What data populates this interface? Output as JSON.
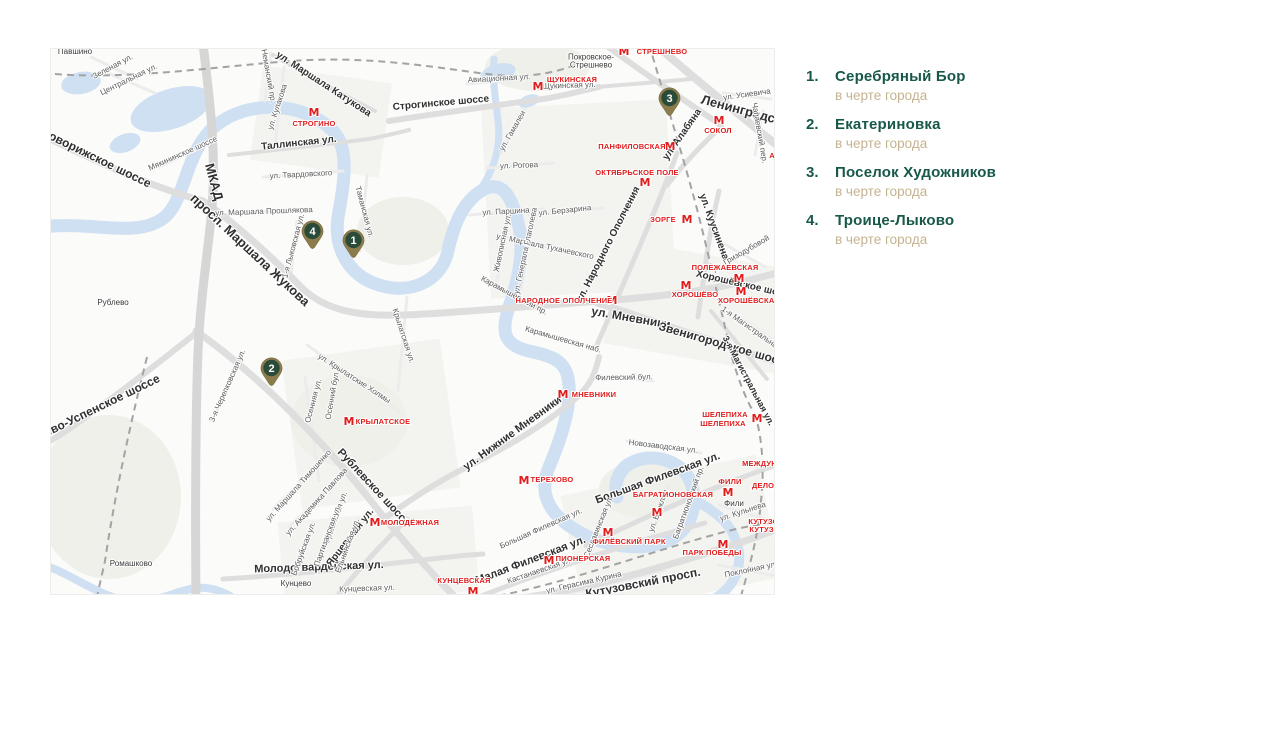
{
  "colors": {
    "green": "#17584a",
    "tan": "#c5b390",
    "metro_red": "#e01c1c",
    "pin_outer": "#8c7b4b",
    "pin_inner": "#2b4b3a",
    "water": "#cfe0f3"
  },
  "legend": {
    "items": [
      {
        "number": "1.",
        "title": "Серебряный Бор",
        "subtitle": "в черте города"
      },
      {
        "number": "2.",
        "title": "Екатериновка",
        "subtitle": "в черте города"
      },
      {
        "number": "3.",
        "title": "Поселок Художников",
        "subtitle": "в черте города"
      },
      {
        "number": "4.",
        "title": "Троице-Лыково",
        "subtitle": "в черте города"
      }
    ]
  },
  "map": {
    "pins": [
      {
        "number": "1",
        "x": 302,
        "y": 191
      },
      {
        "number": "2",
        "x": 220,
        "y": 319
      },
      {
        "number": "3",
        "x": 618,
        "y": 49
      },
      {
        "number": "4",
        "x": 261,
        "y": 182
      }
    ],
    "metro_stations": [
      {
        "label": "СТРЕШНЕВО",
        "icon_x": 573,
        "icon_y": 3,
        "label_x": 611,
        "label_y": 3
      },
      {
        "label": "ЩУКИНСКАЯ",
        "icon_x": 487,
        "icon_y": 38,
        "label_x": 521,
        "label_y": 31
      },
      {
        "label": "СТРОГИНО",
        "icon_x": 263,
        "icon_y": 64,
        "label_x": 263,
        "label_y": 75
      },
      {
        "label": "СОКОЛ",
        "icon_x": 668,
        "icon_y": 72,
        "label_x": 667,
        "label_y": 82
      },
      {
        "label": "ПАНФИЛОВСКАЯ",
        "icon_x": 619,
        "icon_y": 98,
        "label_x": 581,
        "label_y": 98
      },
      {
        "label": "ОКТЯБРЬСКОЕ ПОЛЕ",
        "icon_x": 594,
        "icon_y": 134,
        "label_x": 586,
        "label_y": 124
      },
      {
        "label": "ЗОРГЕ",
        "icon_x": 636,
        "icon_y": 171,
        "label_x": 612,
        "label_y": 171
      },
      {
        "label": "ПОЛЕЖАЕВСКАЯ",
        "icon_x": 688,
        "icon_y": 230,
        "label_x": 674,
        "label_y": 219
      },
      {
        "label": "ХОРОШЁВО",
        "icon_x": 635,
        "icon_y": 237,
        "label_x": 644,
        "label_y": 246
      },
      {
        "label": "ХОРОШЁВСКАЯ",
        "icon_x": 690,
        "icon_y": 243,
        "label_x": 698,
        "label_y": 252
      },
      {
        "label": "НАРОДНОЕ ОПОЛЧЕНИЕ",
        "icon_x": 561,
        "icon_y": 252,
        "label_x": 513,
        "label_y": 252
      },
      {
        "label": "МНЕВНИКИ",
        "icon_x": 512,
        "icon_y": 346,
        "label_x": 543,
        "label_y": 346
      },
      {
        "label": "ТЕРЕХОВО",
        "icon_x": 473,
        "icon_y": 432,
        "label_x": 501,
        "label_y": 431
      },
      {
        "label": "КРЫЛАТСКОЕ",
        "icon_x": 298,
        "icon_y": 373,
        "label_x": 332,
        "label_y": 373
      },
      {
        "label": "МОЛОДЁЖНАЯ",
        "icon_x": 324,
        "icon_y": 474,
        "label_x": 359,
        "label_y": 474
      },
      {
        "label": "ШЕЛЕПИХА",
        "icon_x": 706,
        "icon_y": 370,
        "label_x": 674,
        "label_y": 366
      },
      {
        "label": "ШЕЛЕПИХА",
        "label_x": 672,
        "label_y": 375
      },
      {
        "label": "МЕЖДУНАРОДНАЯ",
        "label_x": 728,
        "label_y": 415
      },
      {
        "label": "ФИЛИ",
        "icon_x": 677,
        "icon_y": 444,
        "label_x": 679,
        "label_y": 433
      },
      {
        "label": "ДЕЛОВОЙ ЦЕНТР",
        "label_x": 735,
        "label_y": 437
      },
      {
        "label": "БАГРАТИОНОВСКАЯ",
        "icon_x": 606,
        "icon_y": 464,
        "label_x": 622,
        "label_y": 446
      },
      {
        "label": "ФИЛЁВСКИЙ ПАРК",
        "icon_x": 557,
        "icon_y": 484,
        "label_x": 578,
        "label_y": 493
      },
      {
        "label": "ПИОНЕРСКАЯ",
        "icon_x": 498,
        "icon_y": 512,
        "label_x": 532,
        "label_y": 510
      },
      {
        "label": "КУНЦЕВСКАЯ",
        "icon_x": 422,
        "icon_y": 543,
        "label_x": 413,
        "label_y": 532
      },
      {
        "label": "ПАРК ПОБЕДЫ",
        "icon_x": 672,
        "icon_y": 496,
        "label_x": 661,
        "label_y": 504
      },
      {
        "label": "КУТУЗОВСКАЯ",
        "label_x": 726,
        "label_y": 473
      },
      {
        "label": "КУТУЗОВСКАЯ",
        "label_x": 727,
        "label_y": 481
      },
      {
        "label": "АЭРОПОРТ",
        "label_x": 740,
        "label_y": 107
      }
    ],
    "street_labels": [
      {
        "text": "Новорижское шоссе",
        "x": 45,
        "y": 109,
        "rot": 26,
        "size": 12,
        "bold": true
      },
      {
        "text": "МКАД",
        "x": 163,
        "y": 133,
        "rot": 75,
        "size": 13,
        "bold": true
      },
      {
        "text": "просп. Маршала Жукова",
        "x": 199,
        "y": 201,
        "rot": 43,
        "size": 13,
        "bold": true
      },
      {
        "text": "Ленинградский",
        "x": 698,
        "y": 63,
        "rot": 15,
        "size": 13,
        "bold": true
      },
      {
        "text": "ул. Мневники",
        "x": 580,
        "y": 269,
        "rot": 10,
        "size": 12,
        "bold": true
      },
      {
        "text": "Звенигородское шоссе",
        "x": 674,
        "y": 296,
        "rot": 16,
        "size": 12,
        "bold": true
      },
      {
        "text": "Хорошёвское шоссе",
        "x": 694,
        "y": 237,
        "rot": 13,
        "size": 10,
        "bold": true
      },
      {
        "text": "ул. Нижние Мневники",
        "x": 462,
        "y": 385,
        "rot": -36,
        "size": 11,
        "bold": true
      },
      {
        "text": "Большая Филевская ул.",
        "x": 607,
        "y": 430,
        "rot": -20,
        "size": 11,
        "bold": true
      },
      {
        "text": "Малая Филевская ул.",
        "x": 480,
        "y": 512,
        "rot": -21,
        "size": 11,
        "bold": true
      },
      {
        "text": "Кутузовский просп.",
        "x": 592,
        "y": 534,
        "rot": -11,
        "size": 12,
        "bold": true
      },
      {
        "text": "Молодогвардейская ул.",
        "x": 268,
        "y": 519,
        "rot": -2,
        "size": 11,
        "bold": true
      },
      {
        "text": "Рублевское шоссе",
        "x": 322,
        "y": 439,
        "rot": 47,
        "size": 11,
        "bold": true
      },
      {
        "text": "Ярцевская ул.",
        "x": 300,
        "y": 489,
        "rot": -52,
        "size": 10,
        "bold": true
      },
      {
        "text": "Рублево-Успенское шоссе",
        "x": 38,
        "y": 363,
        "rot": -26,
        "size": 12,
        "bold": true
      },
      {
        "text": "ул. Маршала Катукова",
        "x": 272,
        "y": 36,
        "rot": 33,
        "size": 10,
        "bold": true
      },
      {
        "text": "ул. Народного Ополчения",
        "x": 558,
        "y": 196,
        "rot": -63,
        "size": 10,
        "bold": true
      },
      {
        "text": "ул. Алабяна",
        "x": 632,
        "y": 86,
        "rot": -55,
        "size": 10,
        "bold": true
      },
      {
        "text": "ул. Куусинена",
        "x": 662,
        "y": 178,
        "rot": 70,
        "size": 10,
        "bold": true
      },
      {
        "text": "Таллинская ул.",
        "x": 248,
        "y": 95,
        "rot": -6,
        "size": 10,
        "bold": true
      },
      {
        "text": "Строгинское шоссе",
        "x": 390,
        "y": 55,
        "rot": -5,
        "size": 10,
        "bold": true
      },
      {
        "text": "3-я Магистральная ул.",
        "x": 697,
        "y": 332,
        "rot": 62,
        "size": 9,
        "bold": true
      },
      {
        "text": "Карамышевская наб.",
        "x": 512,
        "y": 291,
        "rot": 16
      },
      {
        "text": "Карамышевский пр.",
        "x": 463,
        "y": 247,
        "rot": 28
      },
      {
        "text": "ул. Кулакова",
        "x": 227,
        "y": 58,
        "rot": -72
      },
      {
        "text": "ул. Твардовского",
        "x": 250,
        "y": 126,
        "rot": -3
      },
      {
        "text": "ул. Маршала Прошлякова",
        "x": 213,
        "y": 163,
        "rot": -2
      },
      {
        "text": "Мякининское шоссе",
        "x": 132,
        "y": 105,
        "rot": -24
      },
      {
        "text": "Щукинская ул.",
        "x": 518,
        "y": 37,
        "rot": -2
      },
      {
        "text": "Авиационная ул.",
        "x": 448,
        "y": 30,
        "rot": -3
      },
      {
        "text": "ул. Гамалеи",
        "x": 462,
        "y": 82,
        "rot": -60
      },
      {
        "text": "ул. Рогова",
        "x": 468,
        "y": 117,
        "rot": -2
      },
      {
        "text": "ул. Паршина",
        "x": 455,
        "y": 163,
        "rot": -3
      },
      {
        "text": "ул. Берзарина",
        "x": 514,
        "y": 162,
        "rot": -6
      },
      {
        "text": "ул. Маршала Тухачевского",
        "x": 494,
        "y": 198,
        "rot": 12
      },
      {
        "text": "ул. Генерала Глаголева",
        "x": 475,
        "y": 202,
        "rot": -78
      },
      {
        "text": "Живописная ул.",
        "x": 452,
        "y": 194,
        "rot": -78
      },
      {
        "text": "Осенняя ул.",
        "x": 263,
        "y": 352,
        "rot": -75
      },
      {
        "text": "Осенний бул.",
        "x": 282,
        "y": 346,
        "rot": -80
      },
      {
        "text": "ул. Крылатские Холмы",
        "x": 303,
        "y": 330,
        "rot": 33
      },
      {
        "text": "Крылатская ул.",
        "x": 352,
        "y": 287,
        "rot": 72
      },
      {
        "text": "ул. Маршала Тимошенко",
        "x": 248,
        "y": 437,
        "rot": -48
      },
      {
        "text": "ул. Академика Павлова",
        "x": 266,
        "y": 453,
        "rot": -48
      },
      {
        "text": "Оршанская ул.",
        "x": 285,
        "y": 469,
        "rot": -70
      },
      {
        "text": "Партизанская ул.",
        "x": 277,
        "y": 487,
        "rot": -70
      },
      {
        "text": "Бобруйская ул.",
        "x": 253,
        "y": 500,
        "rot": -70
      },
      {
        "text": "Ельнинская ул.",
        "x": 297,
        "y": 497,
        "rot": -70
      },
      {
        "text": "3-я Черепковская ул.",
        "x": 177,
        "y": 337,
        "rot": -66
      },
      {
        "text": "Филевский бул.",
        "x": 573,
        "y": 329,
        "rot": -1
      },
      {
        "text": "Новозаводская ул.",
        "x": 612,
        "y": 398,
        "rot": 7
      },
      {
        "text": "Большая Филевская ул.",
        "x": 490,
        "y": 480,
        "rot": -24
      },
      {
        "text": "Кастанаевская ул.",
        "x": 489,
        "y": 522,
        "rot": -19
      },
      {
        "text": "ул. Герасима Курина",
        "x": 533,
        "y": 534,
        "rot": -13
      },
      {
        "text": "Таманская ул.",
        "x": 313,
        "y": 163,
        "rot": 75
      },
      {
        "text": "Неманский пр.",
        "x": 217,
        "y": 27,
        "rot": 80
      },
      {
        "text": "Зеленая ул.",
        "x": 62,
        "y": 18,
        "rot": -28
      },
      {
        "text": "Центральная ул.",
        "x": 78,
        "y": 31,
        "rot": -26
      },
      {
        "text": "1-я Лыковская ул.",
        "x": 243,
        "y": 197,
        "rot": -75
      },
      {
        "text": "Чапаевский пер.",
        "x": 708,
        "y": 84,
        "rot": 80
      },
      {
        "text": "ул. Усиевича",
        "x": 696,
        "y": 46,
        "rot": -8
      },
      {
        "text": "Поклонная ул.",
        "x": 700,
        "y": 521,
        "rot": -12
      },
      {
        "text": "Багратионовский пр.",
        "x": 638,
        "y": 454,
        "rot": -70
      },
      {
        "text": "ул. Барклая",
        "x": 608,
        "y": 462,
        "rot": -70
      },
      {
        "text": "Сеславинская ул.",
        "x": 548,
        "y": 478,
        "rot": -68
      },
      {
        "text": "ул. Кульнева",
        "x": 692,
        "y": 463,
        "rot": -18
      },
      {
        "text": "ул. Гризодубовой",
        "x": 690,
        "y": 205,
        "rot": -30
      },
      {
        "text": "1-я Магистральная",
        "x": 700,
        "y": 280,
        "rot": 35
      },
      {
        "text": "Кунцевская ул.",
        "x": 316,
        "y": 540,
        "rot": -2
      }
    ],
    "places": [
      {
        "text": "Павшино",
        "x": 24,
        "y": 3
      },
      {
        "text": "Рублево",
        "x": 62,
        "y": 254
      },
      {
        "text": "Ромашково",
        "x": 80,
        "y": 515
      },
      {
        "text": "Кунцево",
        "x": 245,
        "y": 535
      },
      {
        "text": "Фили",
        "x": 683,
        "y": 455
      },
      {
        "text": "Покровское-\nСтрешнево",
        "x": 540,
        "y": 13
      }
    ]
  }
}
